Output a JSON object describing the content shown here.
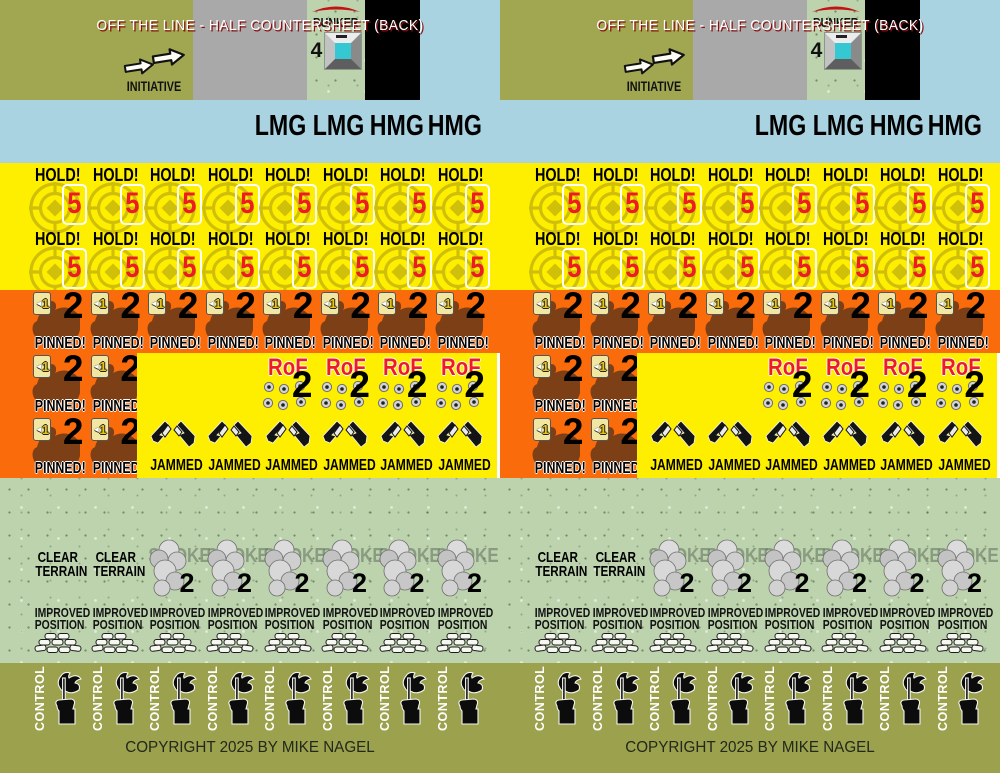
{
  "sheet": {
    "halves": 2,
    "title": "OFF THE LINE - HALF COUNTERSHEET (BACK)",
    "copyright": "COPYRIGHT 2025 BY MIKE NAGEL",
    "colors": {
      "olive_top": "#a1a750",
      "olive_bottom": "#9ba14c",
      "gray": "#a9a9a9",
      "blue": "#aad3e2",
      "yellow": "#feee00",
      "orange": "#fa6b0c",
      "green_texture": "#bcd3ae",
      "black": "#000000",
      "red": "#ed1c24",
      "title_shadow": "#8c0f0f",
      "soldier_brown": "#7d3f16",
      "bunker_teal": "#35c7d2",
      "target_yellow": "#c9b70c"
    },
    "initiative": {
      "label": "INITIATIVE"
    },
    "bunker": {
      "label": "BUNKER",
      "value": "4"
    },
    "weapons": [
      "LMG",
      "LMG",
      "HMG",
      "HMG"
    ],
    "hold": {
      "label": "HOLD!",
      "values": [
        "5",
        "5",
        "5",
        "5",
        "5",
        "5",
        "5",
        "5",
        "5",
        "5",
        "5",
        "5",
        "5",
        "5",
        "5",
        "5"
      ]
    },
    "pinned": {
      "label": "PINNED!",
      "modifier_arrow": "◄",
      "modifier": "1",
      "row_values": [
        "2",
        "2",
        "2",
        "2",
        "2",
        "2",
        "2",
        "2"
      ],
      "side_values": [
        "2",
        "2",
        "2",
        "2"
      ]
    },
    "rof": {
      "label": "RoF",
      "values": [
        "2",
        "2",
        "2",
        "2"
      ]
    },
    "jammed": {
      "labels": [
        "JAMMED",
        "JAMMED",
        "JAMMED",
        "JAMMED",
        "JAMMED",
        "JAMMED"
      ]
    },
    "clear_terrain": {
      "line1": "CLEAR",
      "line2": "TERRAIN",
      "items": [
        "",
        ""
      ]
    },
    "smoke": {
      "label": "SMOKE",
      "values": [
        "2",
        "2",
        "2",
        "2",
        "2",
        "2"
      ]
    },
    "improved": {
      "line1": "IMPROVED",
      "line2": "POSITION",
      "items": [
        "",
        "",
        "",
        "",
        "",
        "",
        "",
        ""
      ]
    },
    "control": {
      "labels": [
        "CONTROL",
        "CONTROL",
        "CONTROL",
        "CONTROL",
        "CONTROL",
        "CONTROL",
        "CONTROL",
        "CONTROL"
      ]
    }
  }
}
